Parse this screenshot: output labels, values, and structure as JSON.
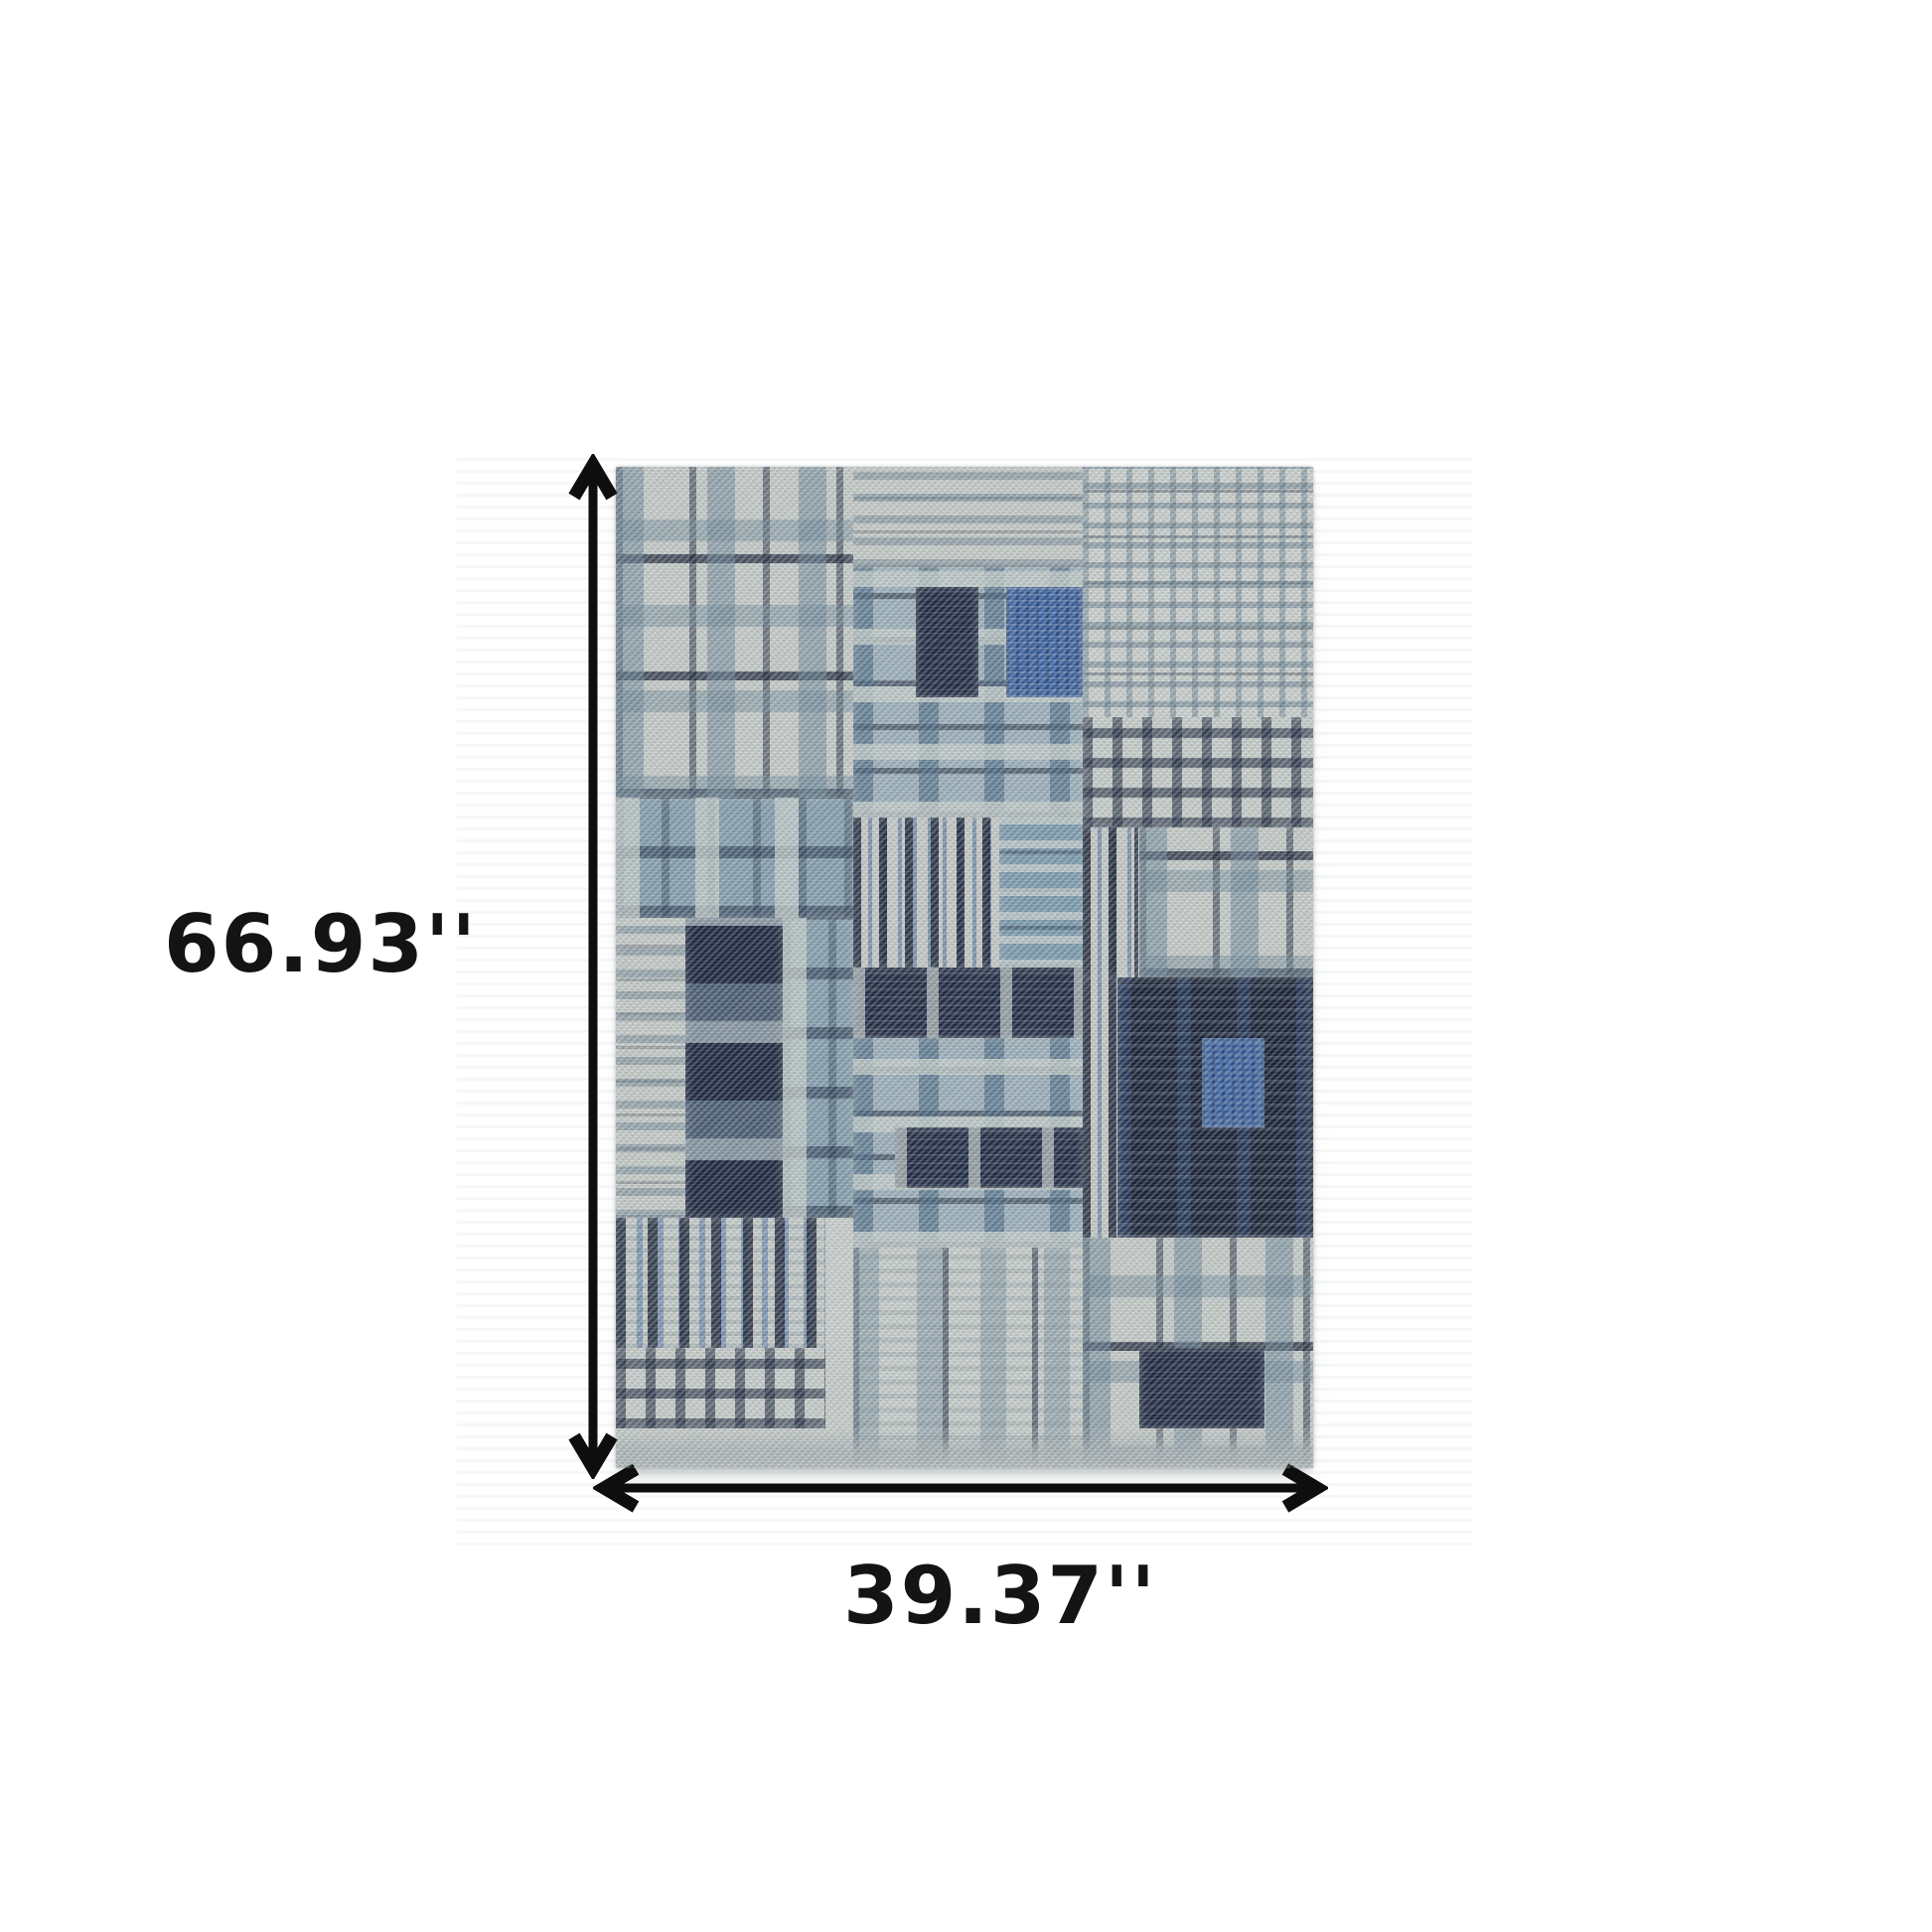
{
  "product": {
    "subject": "patchwork-plaid-area-rug"
  },
  "dimensions": {
    "height": {
      "value": "66.93''"
    },
    "width": {
      "value": "39.37''"
    }
  },
  "palette": {
    "light": "#c6ccc9",
    "steel": "#6e93a6",
    "blue": "#3c63a0",
    "navy": "#202b42",
    "teal": "#4e7387",
    "text": "#141414",
    "arrow": "#0e0e0e",
    "photo_bg_stripe": "#f6f7f7"
  },
  "rug": {
    "patches": [
      {
        "x": 0,
        "y": 0,
        "w": 34,
        "h": 33,
        "cls": "plaid-a"
      },
      {
        "x": 34,
        "y": 0,
        "w": 33,
        "h": 10,
        "cls": "hstripes"
      },
      {
        "x": 67,
        "y": 0,
        "w": 33,
        "h": 30,
        "cls": "checkfine"
      },
      {
        "x": 34,
        "y": 10,
        "w": 33,
        "h": 25,
        "cls": "plaid-b"
      },
      {
        "x": 43,
        "y": 12,
        "w": 9,
        "h": 11,
        "cls": "navy-block"
      },
      {
        "x": 56,
        "y": 12,
        "w": 11,
        "h": 11,
        "cls": "blue-block"
      },
      {
        "x": 67,
        "y": 25,
        "w": 33,
        "h": 11,
        "cls": "check"
      },
      {
        "x": 0,
        "y": 33,
        "w": 34,
        "h": 12,
        "cls": "plaid-blue"
      },
      {
        "x": 34,
        "y": 35,
        "w": 21,
        "h": 15,
        "cls": "vstripes"
      },
      {
        "x": 55,
        "y": 35,
        "w": 12,
        "h": 15,
        "cls": "blue-h"
      },
      {
        "x": 67,
        "y": 36,
        "w": 8,
        "h": 15,
        "cls": "vstripes"
      },
      {
        "x": 75,
        "y": 36,
        "w": 25,
        "h": 15,
        "cls": "plaid-a"
      },
      {
        "x": 0,
        "y": 45,
        "w": 10,
        "h": 30,
        "cls": "hstripes"
      },
      {
        "x": 10,
        "y": 45,
        "w": 14,
        "h": 30,
        "cls": "navy-col"
      },
      {
        "x": 24,
        "y": 45,
        "w": 10,
        "h": 30,
        "cls": "plaid-blue"
      },
      {
        "x": 34,
        "y": 50,
        "w": 33,
        "h": 7,
        "cls": "hband-navy"
      },
      {
        "x": 34,
        "y": 57,
        "w": 33,
        "h": 21,
        "cls": "plaid-b"
      },
      {
        "x": 40,
        "y": 66,
        "w": 27,
        "h": 6,
        "cls": "hband-navy"
      },
      {
        "x": 67,
        "y": 51,
        "w": 5,
        "h": 26,
        "cls": "vstripes"
      },
      {
        "x": 72,
        "y": 51,
        "w": 28,
        "h": 26,
        "cls": "dark"
      },
      {
        "x": 84,
        "y": 57,
        "w": 9,
        "h": 9,
        "cls": "blue-block"
      },
      {
        "x": 0,
        "y": 75,
        "w": 30,
        "h": 13,
        "cls": "vstripes-wide"
      },
      {
        "x": 30,
        "y": 75,
        "w": 4,
        "h": 13,
        "cls": "light"
      },
      {
        "x": 0,
        "y": 88,
        "w": 30,
        "h": 8,
        "cls": "check"
      },
      {
        "x": 34,
        "y": 78,
        "w": 33,
        "h": 22,
        "cls": "vcols"
      },
      {
        "x": 67,
        "y": 77,
        "w": 33,
        "h": 23,
        "cls": "plaid-a"
      },
      {
        "x": 75,
        "y": 88,
        "w": 18,
        "h": 8,
        "cls": "navy-block"
      },
      {
        "x": 0,
        "y": 96,
        "w": 100,
        "h": 4,
        "cls": "edge"
      }
    ]
  }
}
